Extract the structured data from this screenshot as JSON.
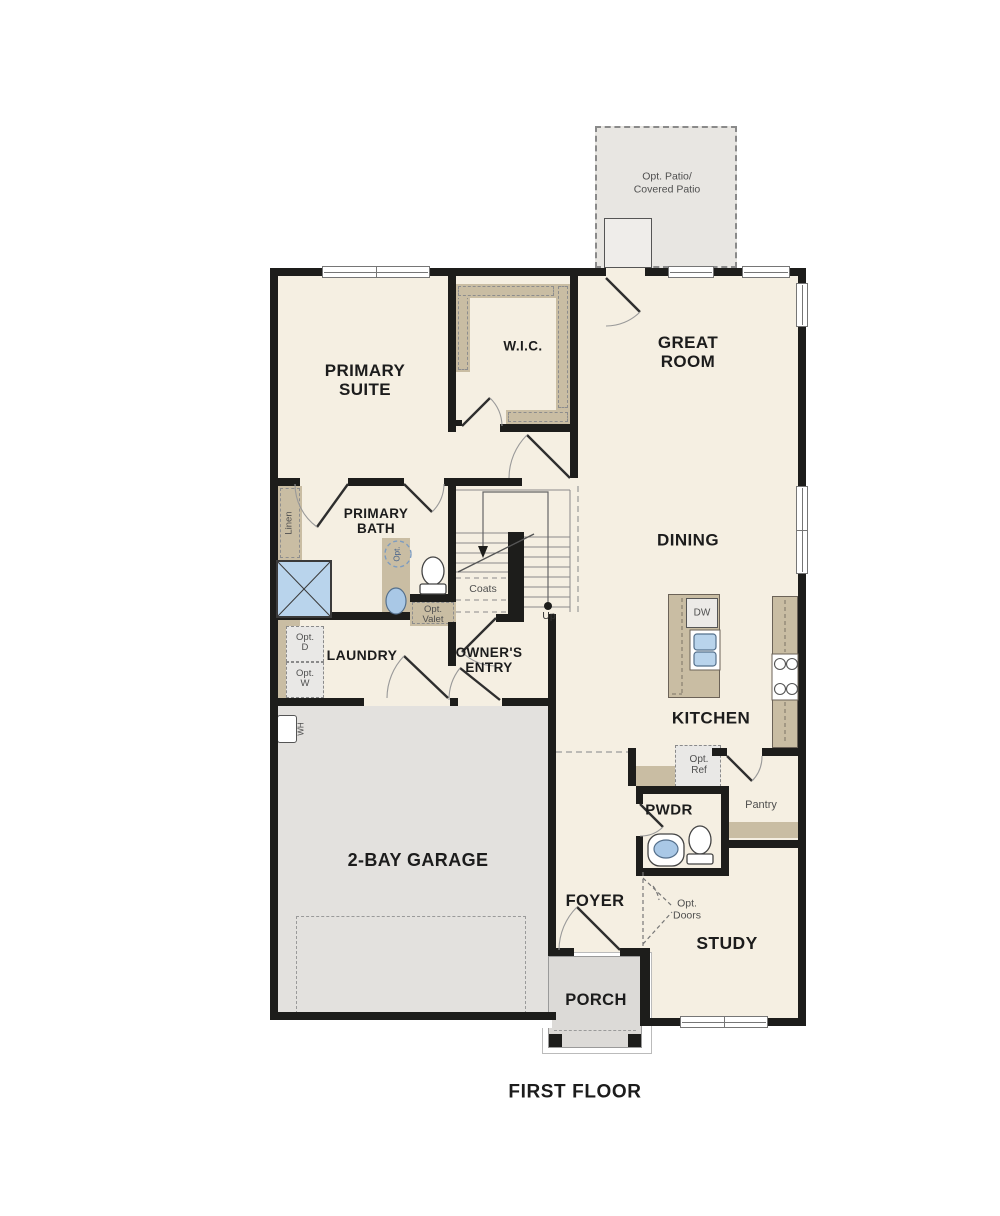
{
  "title": "FIRST FLOOR",
  "colors": {
    "wall": "#1d1d1b",
    "floor": "#f5efe2",
    "cabinet_tan": "#c9bda3",
    "garage_gray": "#e3e1de",
    "patio_gray": "#e8e6e2",
    "porch_gray": "#dcdad7",
    "fixture_blue": "#b9d4ec",
    "muted_text": "#4f4f4f"
  },
  "labels": {
    "patio": {
      "l1": "Opt. Patio/",
      "l2": "Covered Patio"
    },
    "primary_suite": {
      "l1": "PRIMARY",
      "l2": "SUITE"
    },
    "wic": {
      "l1": "W.I.C."
    },
    "great_room": {
      "l1": "GREAT",
      "l2": "ROOM"
    },
    "dining": {
      "l1": "DINING"
    },
    "kitchen": {
      "l1": "KITCHEN"
    },
    "primary_bath": {
      "l1": "PRIMARY",
      "l2": "BATH"
    },
    "laundry": {
      "l1": "LAUNDRY"
    },
    "owners_entry": {
      "l1": "OWNER'S",
      "l2": "ENTRY"
    },
    "garage": {
      "l1": "2-BAY GARAGE"
    },
    "pwdr": {
      "l1": "PWDR"
    },
    "foyer": {
      "l1": "FOYER"
    },
    "study": {
      "l1": "STUDY"
    },
    "porch": {
      "l1": "PORCH"
    },
    "pantry": {
      "l1": "Pantry"
    },
    "coats": {
      "l1": "Coats"
    },
    "linen": {
      "l1": "Linen"
    },
    "up": {
      "l1": "Up"
    },
    "dw": {
      "l1": "DW"
    },
    "wh": {
      "l1": "WH"
    },
    "opt_valet": {
      "l1": "Opt.",
      "l2": "Valet"
    },
    "opt_d": {
      "l1": "Opt.",
      "l2": "D"
    },
    "opt_w": {
      "l1": "Opt.",
      "l2": "W"
    },
    "opt_ref": {
      "l1": "Opt.",
      "l2": "Ref"
    },
    "opt_doors": {
      "l1": "Opt.",
      "l2": "Doors"
    },
    "opt_vanity": {
      "l1": "Opt."
    }
  }
}
